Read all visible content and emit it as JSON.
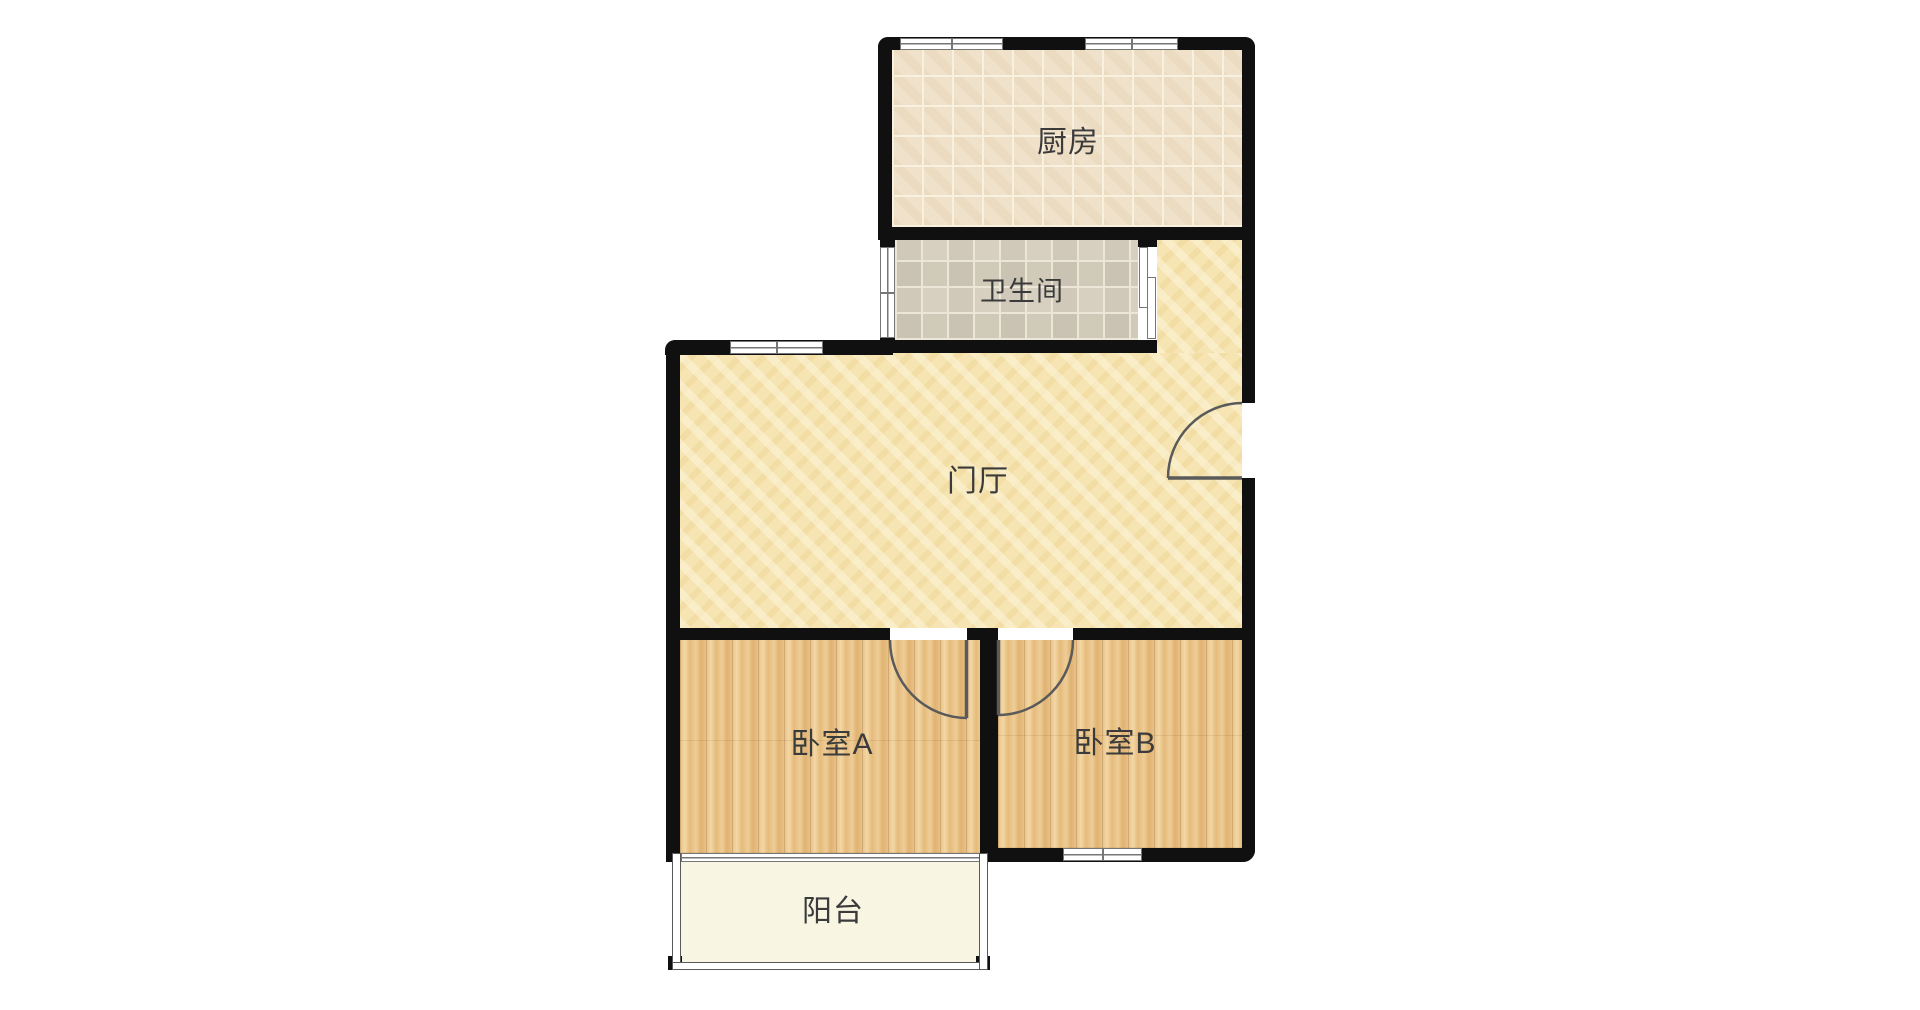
{
  "rooms": {
    "kitchen": {
      "label": "厨房"
    },
    "bathroom": {
      "label": "卫生间"
    },
    "hall": {
      "label": "门厅"
    },
    "bedroom_a": {
      "label": "卧室A"
    },
    "bedroom_b": {
      "label": "卧室B"
    },
    "balcony": {
      "label": "阳台"
    }
  },
  "colors": {
    "wall": "#101010",
    "kitchen_floor": "#f0e2ca",
    "grout_light": "#f9f1e0",
    "bath_floor": "#d7d0c0",
    "grout_bath": "#ece6d8",
    "hall_floor": "#f6e5b2",
    "wood_floor": "#eac88f",
    "balcony_floor": "#f8f5e2",
    "frame": "#767676",
    "rail": "#5a5a5a",
    "door_arc": "#5a5a5a",
    "text": "#3b3b3b"
  }
}
